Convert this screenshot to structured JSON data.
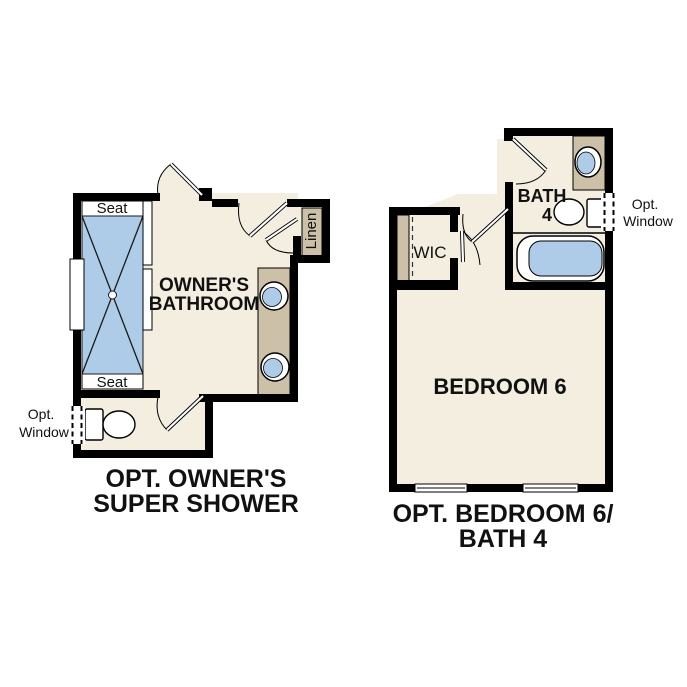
{
  "colors": {
    "floor": "#f4eee1",
    "fixture_blue": "#aecbe8",
    "counter_tan": "#ccc0a8",
    "wall": "#000000",
    "text": "#111111"
  },
  "left_plan": {
    "caption_line1": "OPT. OWNER'S",
    "caption_line2": "SUPER SHOWER",
    "room_line1": "OWNER'S",
    "room_line2": "BATHROOM",
    "seat_top": "Seat",
    "seat_bottom": "Seat",
    "linen_label": "Linen",
    "opt_window_line1": "Opt.",
    "opt_window_line2": "Window"
  },
  "right_plan": {
    "caption_line1": "OPT. BEDROOM 6/",
    "caption_line2": "BATH 4",
    "bedroom_label": "BEDROOM 6",
    "bath_line1": "BATH",
    "bath_line2": "4",
    "wic_label": "WIC",
    "opt_window_line1": "Opt.",
    "opt_window_line2": "Window"
  }
}
